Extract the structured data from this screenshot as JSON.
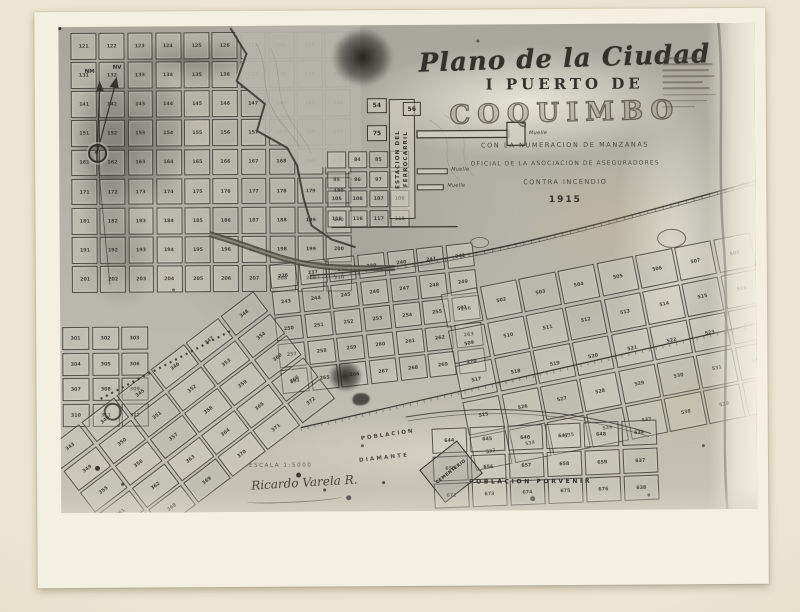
{
  "scan": {
    "paper_color": "#e9e1cc",
    "photo_margin_color": "#f3f0e1",
    "map_tone": "#b4b2a6"
  },
  "title_block": {
    "line1": "Plano de la Ciudad",
    "line2": "I PUERTO DE",
    "line3": "COQUIMBO",
    "sub1": "CON LA NUMERACION DE MANZANAS",
    "sub2": "OFICIAL DE LA ASOCIACION DE ASEGURADORES",
    "sub3": "CONTRA INCENDIO",
    "year": "1915"
  },
  "compass": {
    "north_magnetic": "NM",
    "north_true": "NV"
  },
  "station": {
    "line1": "ESTACION DEL",
    "line2": "FERROCARRIL",
    "pier_label": "Muelle"
  },
  "districts": {
    "cemetery": "CEMENTERIO",
    "poblacion": "POBLACION",
    "diamante": "DIAMANTE",
    "porvenir": "POBLACION  PORVENIR"
  },
  "footer": {
    "scale": "ESCALA 1:5000",
    "signature": "Ricardo Varela R."
  },
  "blocks": {
    "b54": "54",
    "b56": "56",
    "b75": "75"
  },
  "grids": {
    "upper": {
      "numbers": [
        121,
        122,
        123,
        124,
        125,
        126,
        127,
        128,
        129,
        130,
        131,
        132,
        133,
        134,
        135,
        136,
        137,
        138,
        139,
        140,
        141,
        142,
        143,
        144,
        145,
        146,
        147,
        148,
        149,
        150,
        151,
        152,
        153,
        154,
        155,
        156,
        157,
        158,
        159,
        160,
        161,
        162,
        163,
        164,
        165,
        166,
        167,
        168,
        169,
        170,
        171,
        172,
        173,
        174,
        175,
        176,
        177,
        178,
        179,
        180,
        181,
        182,
        183,
        184,
        185,
        186,
        187,
        188,
        189,
        190,
        191,
        192,
        193,
        194,
        195,
        196,
        197,
        198,
        199,
        200,
        201,
        202,
        203,
        204,
        205,
        206,
        207,
        208,
        209,
        210
      ]
    },
    "station_blocks": {
      "numbers": [
        "",
        "84",
        "85",
        "",
        "95",
        "96",
        "97",
        "",
        "105",
        "106",
        "107",
        "108",
        "115",
        "116",
        "117",
        "118"
      ]
    },
    "center_dense": {
      "numbers": [
        236,
        237,
        238,
        239,
        240,
        241,
        242,
        243,
        244,
        245,
        246,
        247,
        248,
        249,
        250,
        251,
        252,
        253,
        254,
        255,
        256,
        257,
        258,
        259,
        260,
        261,
        262,
        263,
        264,
        265,
        266,
        267,
        268,
        269,
        270
      ]
    },
    "center_large": {
      "numbers": [
        501,
        502,
        503,
        504,
        505,
        506,
        507,
        508,
        509,
        510,
        511,
        512,
        513,
        514,
        515,
        516,
        517,
        518,
        519,
        520,
        521,
        522,
        523,
        524,
        525,
        526,
        527,
        528,
        529,
        530,
        531,
        532,
        533,
        534,
        535,
        536,
        537,
        538,
        539,
        540
      ]
    },
    "lower_diagonal": {
      "numbers": [
        343,
        344,
        345,
        346,
        347,
        348,
        349,
        350,
        351,
        352,
        353,
        354,
        355,
        356,
        357,
        358,
        359,
        360,
        361,
        362,
        363,
        364,
        365,
        366,
        367,
        368,
        369,
        370,
        371,
        372
      ]
    },
    "lower_small": {
      "numbers": [
        301,
        302,
        303,
        304,
        305,
        306,
        307,
        308,
        309,
        310,
        311,
        312
      ]
    },
    "porvenir": {
      "numbers": [
        "644",
        "645",
        "646",
        "647",
        "648",
        "634",
        "655",
        "656",
        "657",
        "658",
        "659",
        "637",
        "672",
        "673",
        "674",
        "675",
        "676",
        "638"
      ]
    }
  }
}
